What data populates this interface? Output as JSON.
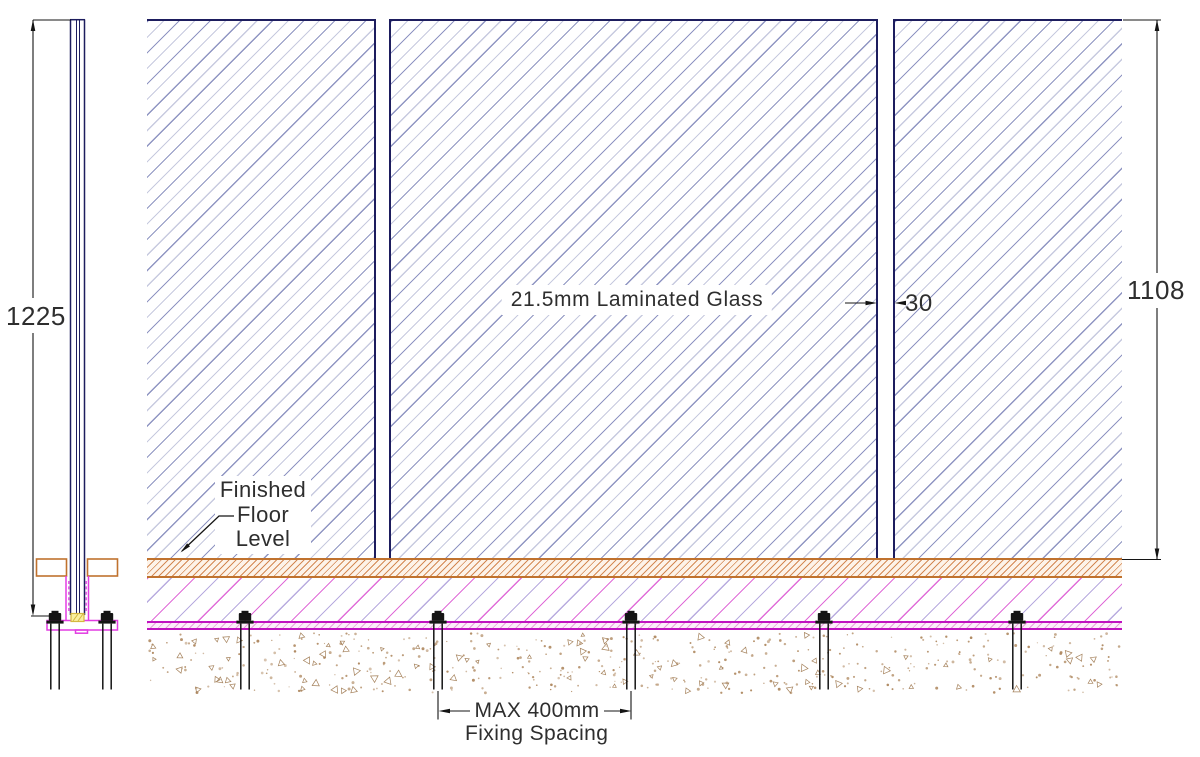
{
  "labels": {
    "glass_panel": "21.5mm Laminated Glass",
    "finished_floor": [
      "Finished",
      "Floor",
      "Level"
    ],
    "fixing_spacing": [
      "MAX 400mm",
      "Fixing Spacing"
    ]
  },
  "dimensions": {
    "overall_glass_height_mm": "1225",
    "height_above_ffl_mm": "1108",
    "panel_gap_mm": "30"
  },
  "colors": {
    "glass_edge_navy": "#1d1d5e",
    "glass_hatch_dark": "#8f95c2",
    "glass_hatch_light": "#c7cadf",
    "floor_finish_orange": "#c0722e",
    "screed_hatch_magenta": "#e06cd8",
    "screed_hatch_violet": "#b8abdf",
    "membrane_magenta": "#c013c0",
    "base_channel_magenta": "#e23ce2",
    "setting_block_yellow": "#d4b840",
    "concrete_speckle_tan": "#b08a62",
    "dimension_black": "#141414",
    "text": "#2e2e2e"
  }
}
